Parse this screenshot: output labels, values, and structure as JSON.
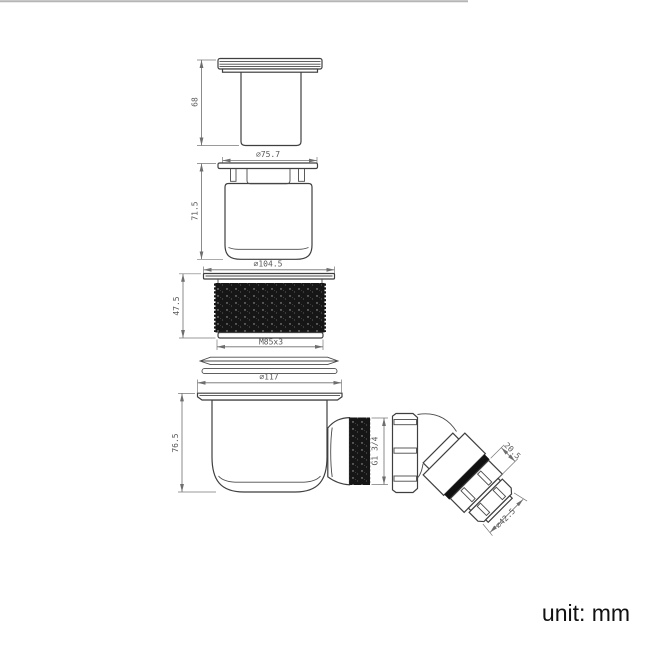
{
  "dims": {
    "cap_height": "68",
    "cap_flange_diameter": "⌀75.7",
    "insert_height": "71.5",
    "thread_flange_diameter": "⌀104.5",
    "thread_height": "47.5",
    "thread_spec": "M85x3",
    "body_flange_diameter": "⌀117",
    "body_height": "76.5",
    "outlet_thread": "G1 3/4",
    "elbow_section_length": "20.5",
    "elbow_nut_diameter": "⌀42.5"
  },
  "footer": {
    "unit_label": "unit: mm"
  },
  "colors": {
    "background": "#ffffff",
    "part_outline": "#3f3f3f",
    "dimension_line": "#6e6e6e",
    "thread_fill": "#161616",
    "top_border": "#b5b5b5"
  }
}
